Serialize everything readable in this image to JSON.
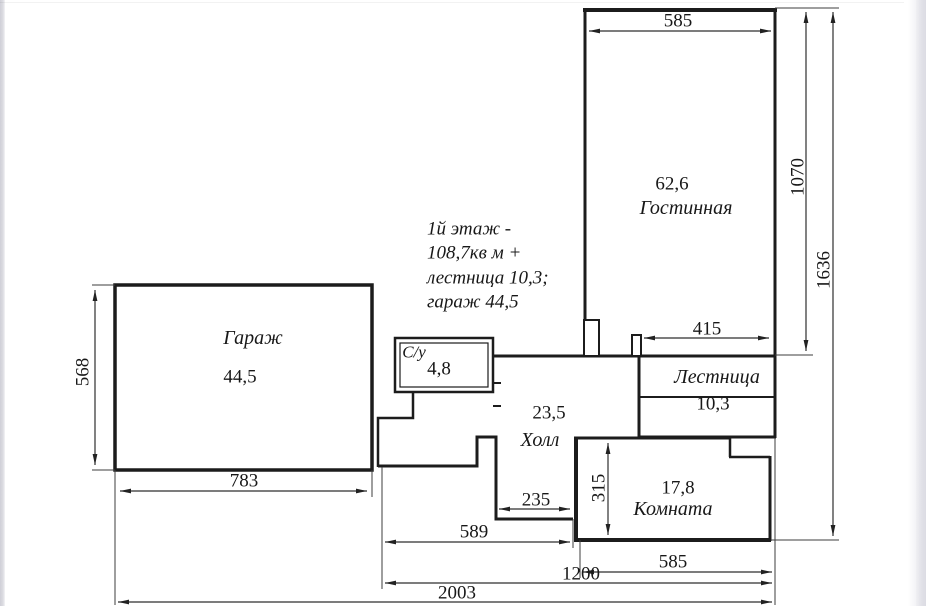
{
  "plan": {
    "note_lines": [
      "1й этаж -",
      "108,7кв м +",
      "лестница 10,3;",
      "гараж 44,5"
    ],
    "rooms": {
      "living": {
        "name": "Гостинная",
        "area": "62,6"
      },
      "garage": {
        "name": "Гараж",
        "area": "44,5"
      },
      "wc": {
        "name": "С/у",
        "area": "4,8"
      },
      "hall": {
        "name": "Холл",
        "area": "23,5"
      },
      "stairs": {
        "name": "Лестница",
        "area": "10,3"
      },
      "room": {
        "name": "Комната",
        "area": "17,8"
      }
    },
    "dims": {
      "living_width": "585",
      "living_height": "1070",
      "total_height": "1636",
      "stairs_width": "415",
      "garage_height": "568",
      "garage_width": "783",
      "niche_width": "235",
      "hall_width": "589",
      "room_height": "315",
      "room_width": "585",
      "wing_width": "1200",
      "total_width": "2003"
    },
    "colors": {
      "wall": "#1c1c1c",
      "dim_line": "#2e2e2e",
      "background": "#ffffff"
    }
  }
}
